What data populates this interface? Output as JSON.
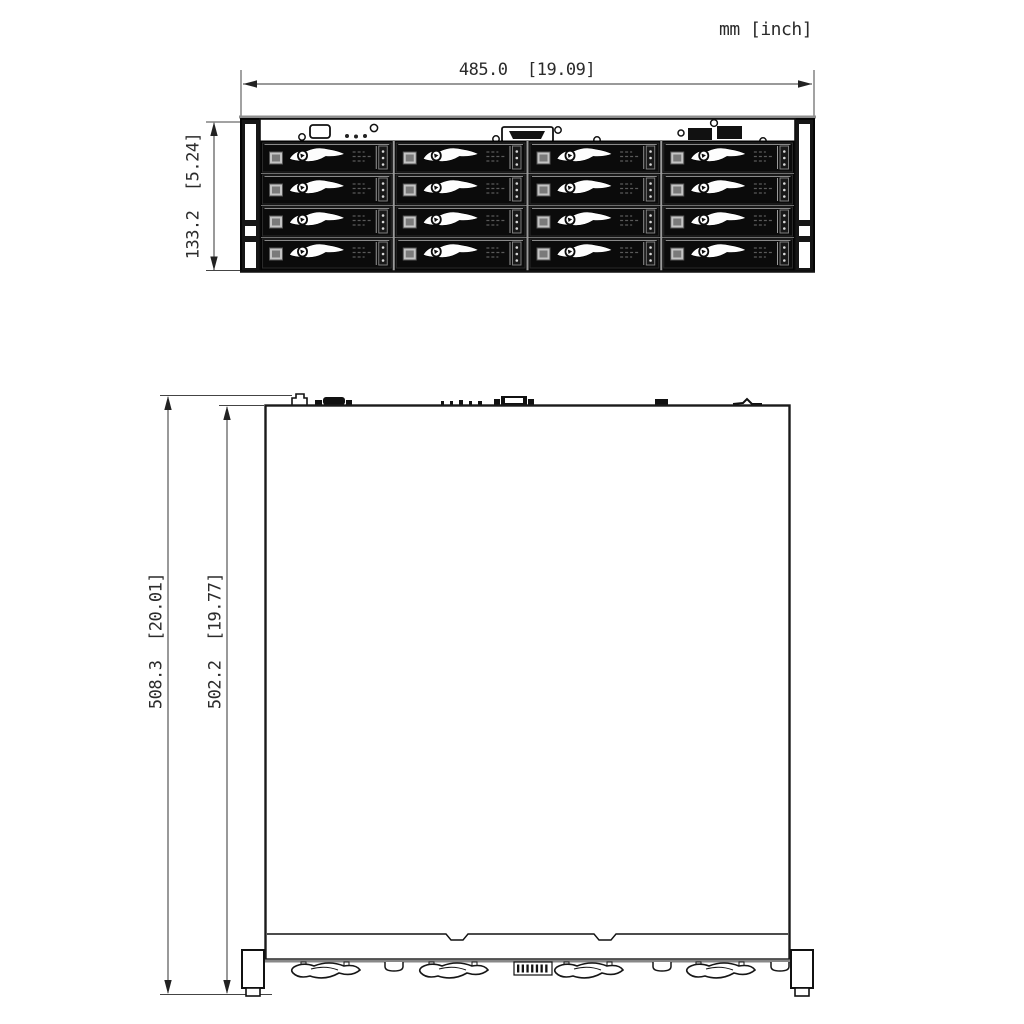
{
  "units_label": "mm [inch]",
  "front_view": {
    "width_dim": "485.0  [19.09]",
    "height_dim": "133.2  [5.24]",
    "drive_bays": {
      "rows": 4,
      "cols": 4
    }
  },
  "top_view": {
    "overall_depth_dim": "508.3  [20.01]",
    "body_depth_dim": "502.2  [19.77]",
    "front_handles": 4,
    "front_cutouts": 3
  },
  "colors": {
    "line": "#1a1a1a",
    "dim_line": "#333333",
    "gray_edge": "#8f8f8f",
    "bay_background": "#060606",
    "tray_face": "#ffffff"
  }
}
